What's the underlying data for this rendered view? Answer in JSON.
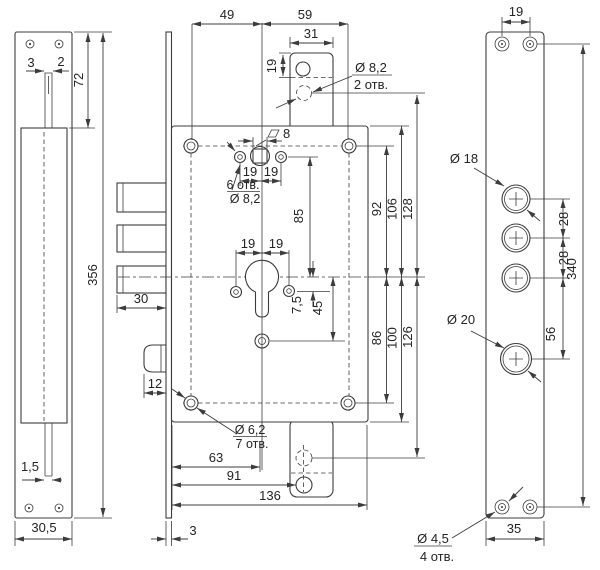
{
  "meta": {
    "background": "#ffffff",
    "line_color": "#3c3c3c",
    "text_color": "#242424",
    "drawing": "door lock mechanism dimensional drawing"
  },
  "strike_plate": {
    "slot_gap": "3",
    "slot_side": "2",
    "upper_section": "72",
    "total_height": "356",
    "slot_width": "1,5",
    "plate_width": "30,5"
  },
  "lock_body": {
    "screws_to_spindle": "49",
    "spindle_to_screws_right": "59",
    "tab_width": "31",
    "tab_hole_depth": "19",
    "square_size": "8",
    "spindle_hole_count": "6 отв.",
    "spindle_hole_dia": "Ø 8,2",
    "tab_hole_dia": "Ø 8,2",
    "tab_hole_count": "2 отв.",
    "spindle_left": "19",
    "spindle_right": "19",
    "spindle_to_axis": "85",
    "axis_to_screws_top": "92",
    "axis_to_body_top": "106",
    "axis_to_tab_hole_top": "128",
    "cyl_left": "19",
    "cyl_right": "19",
    "axis_to_side_hole": "7,5",
    "axis_to_lower_hole": "45",
    "axis_to_screws_bottom": "86",
    "axis_to_body_bottom": "100",
    "axis_to_tab_hole_bottom": "126",
    "bolt_throw": "30",
    "latch_width": "12",
    "screw_hole_dia": "Ø 6,2",
    "screw_hole_count": "7 отв.",
    "face_to_cylinder": "63",
    "face_to_tab_hole": "91",
    "body_length": "136",
    "face_thickness": "3"
  },
  "mounting_bar": {
    "top_holes_span": "19",
    "big_hole_dia": "Ø 18",
    "hole_gap_1": "28",
    "hole_gap_2": "28",
    "total_height": "340",
    "lower_hole_dia": "Ø 20",
    "hole_gap_3": "56",
    "bar_width": "35",
    "small_hole_dia": "Ø 4,5",
    "small_hole_count": "4 отв."
  }
}
